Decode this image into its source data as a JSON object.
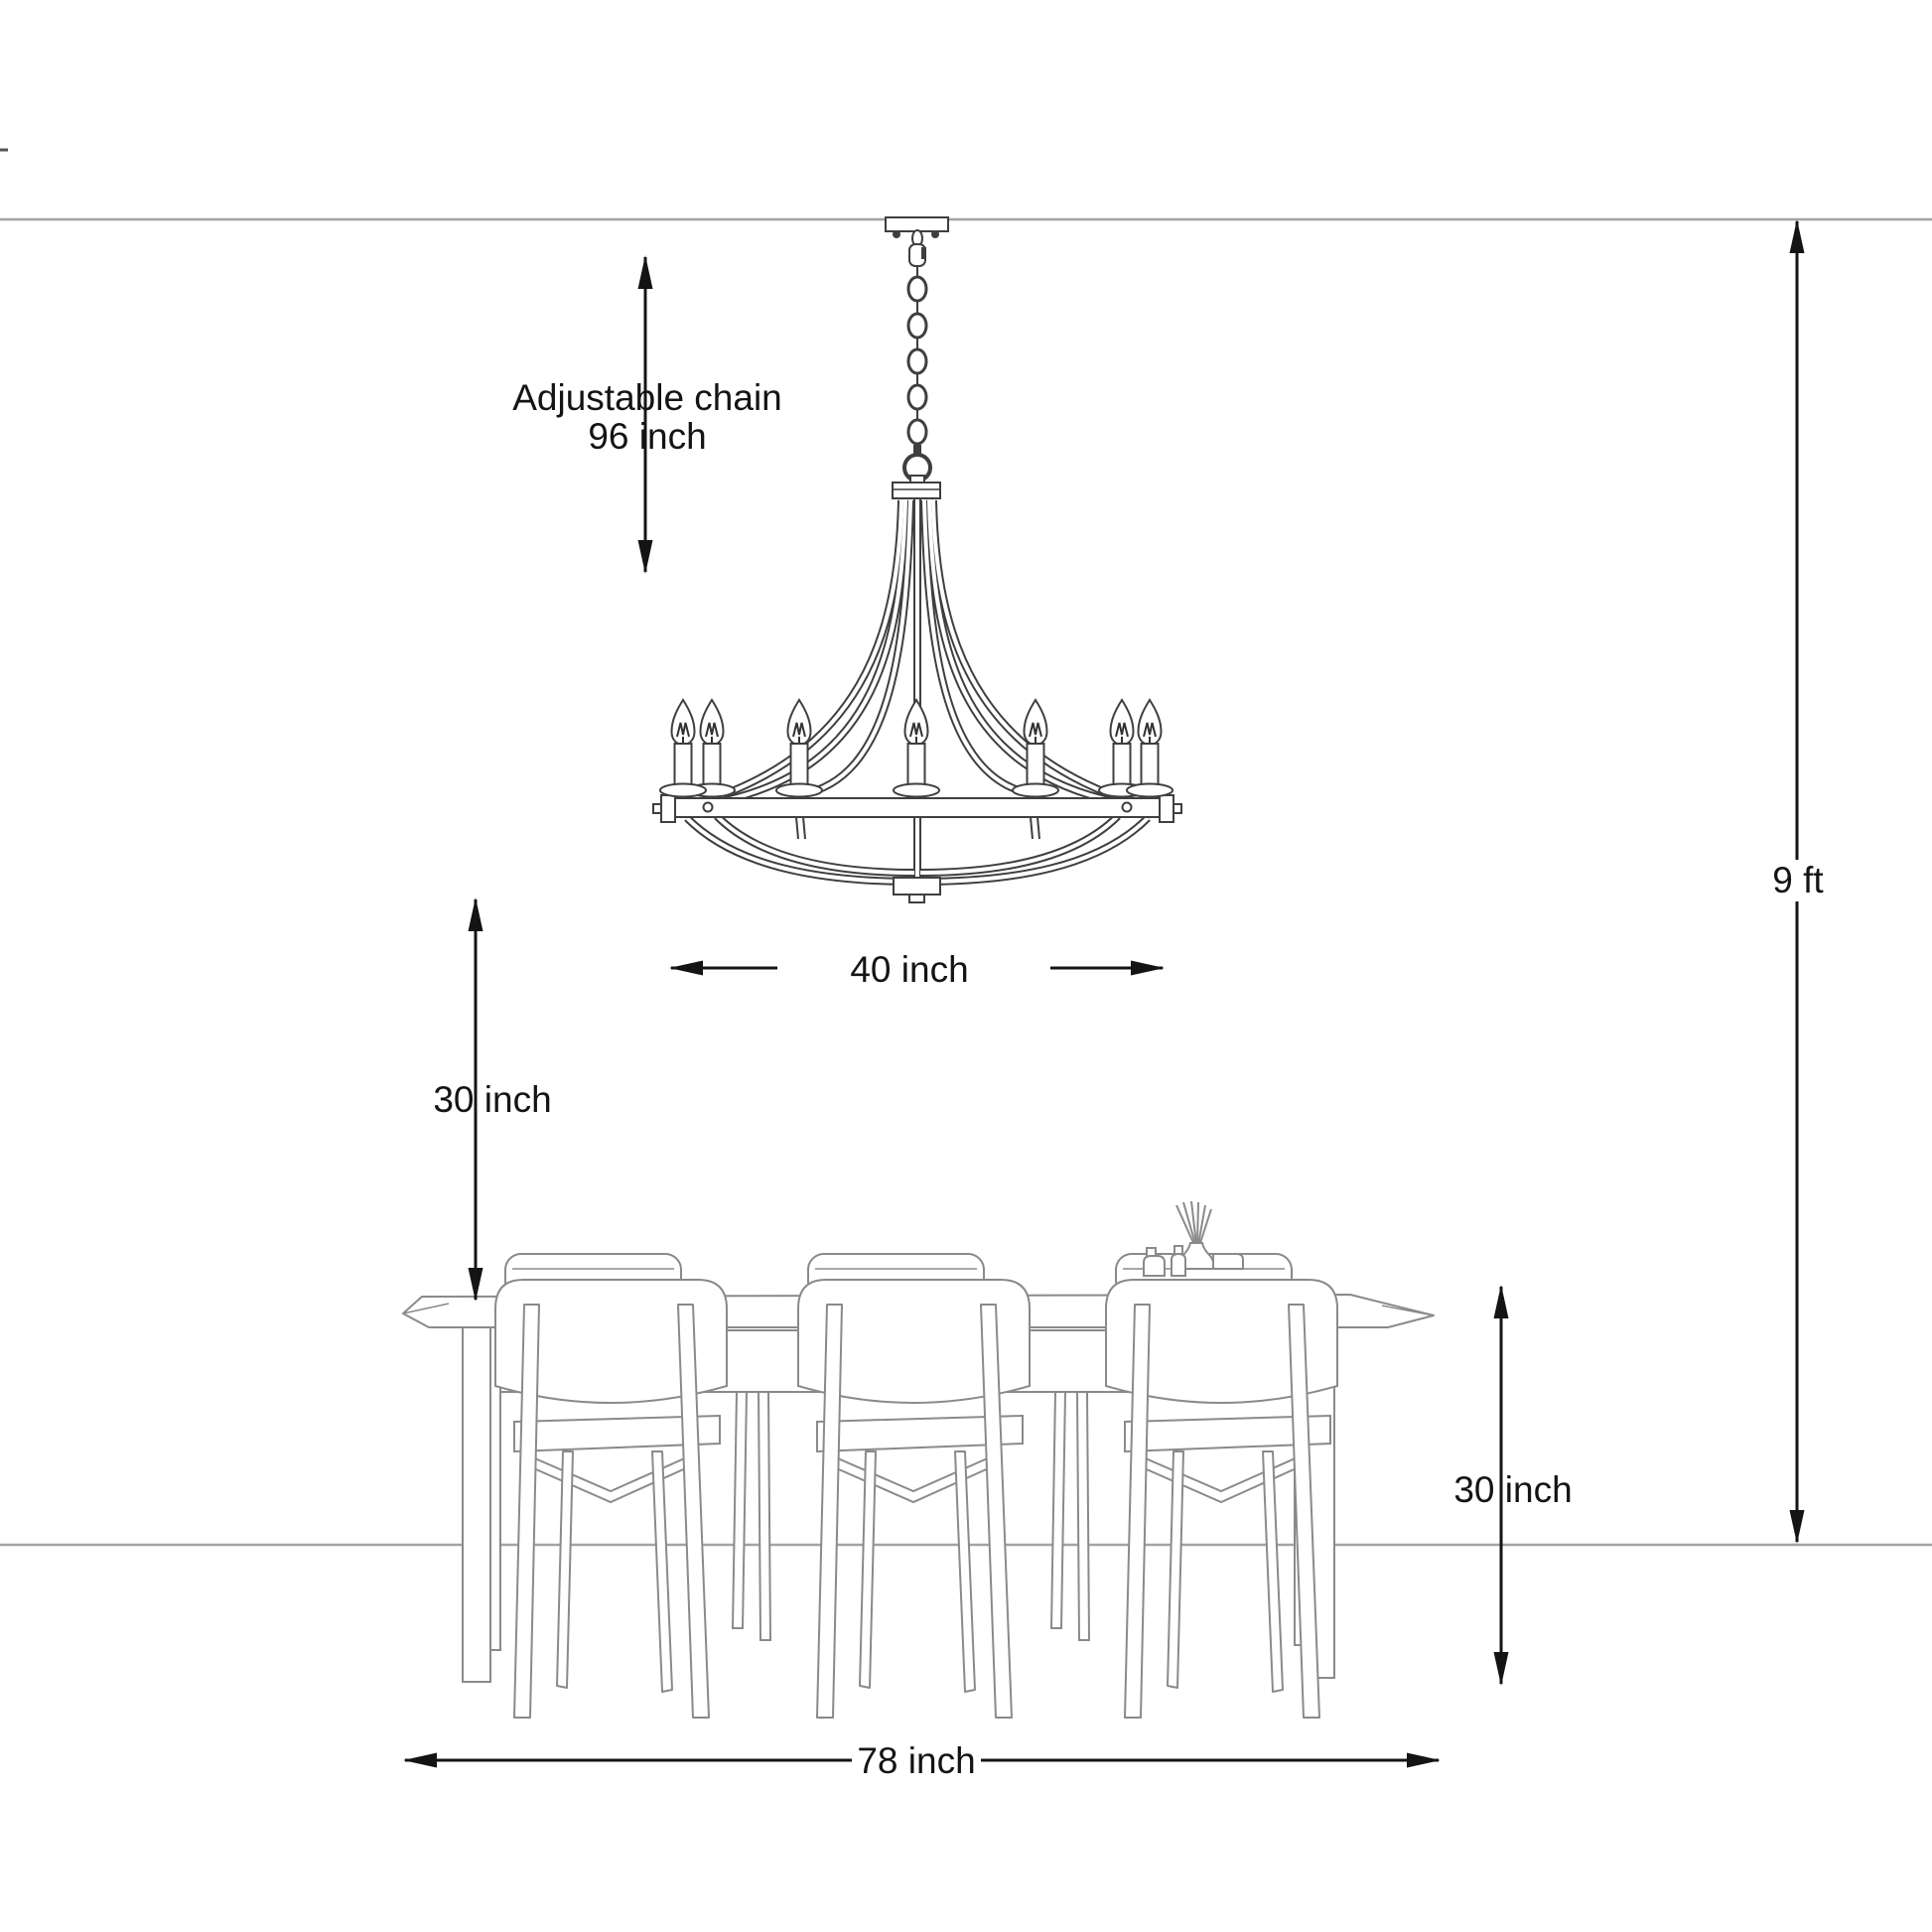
{
  "title": "Chandelier and dining table mounting dimension diagram",
  "colors": {
    "background": "#ffffff",
    "dimension_ink": "#141414",
    "fixture_line": "#3f3f3f",
    "furniture_line": "#8a8a8a",
    "guide_line": "#a3a3a3"
  },
  "annotations": {
    "chain": {
      "line1": "Adjustable chain",
      "line2": "96 inch"
    },
    "fixture_width": "40 inch",
    "clearance_below_fixture": "30 inch",
    "ceiling_height": "9 ft",
    "table_height": "30 inch",
    "table_length": "78 inch"
  },
  "dimensions_data": [
    {
      "name": "adjustable chain length",
      "value": 96,
      "unit": "inch"
    },
    {
      "name": "chandelier width",
      "value": 40,
      "unit": "inch"
    },
    {
      "name": "chandelier to tabletop clearance",
      "value": 30,
      "unit": "inch"
    },
    {
      "name": "ceiling height",
      "value": 9,
      "unit": "ft"
    },
    {
      "name": "table height",
      "value": 30,
      "unit": "inch"
    },
    {
      "name": "table length",
      "value": 78,
      "unit": "inch"
    }
  ]
}
